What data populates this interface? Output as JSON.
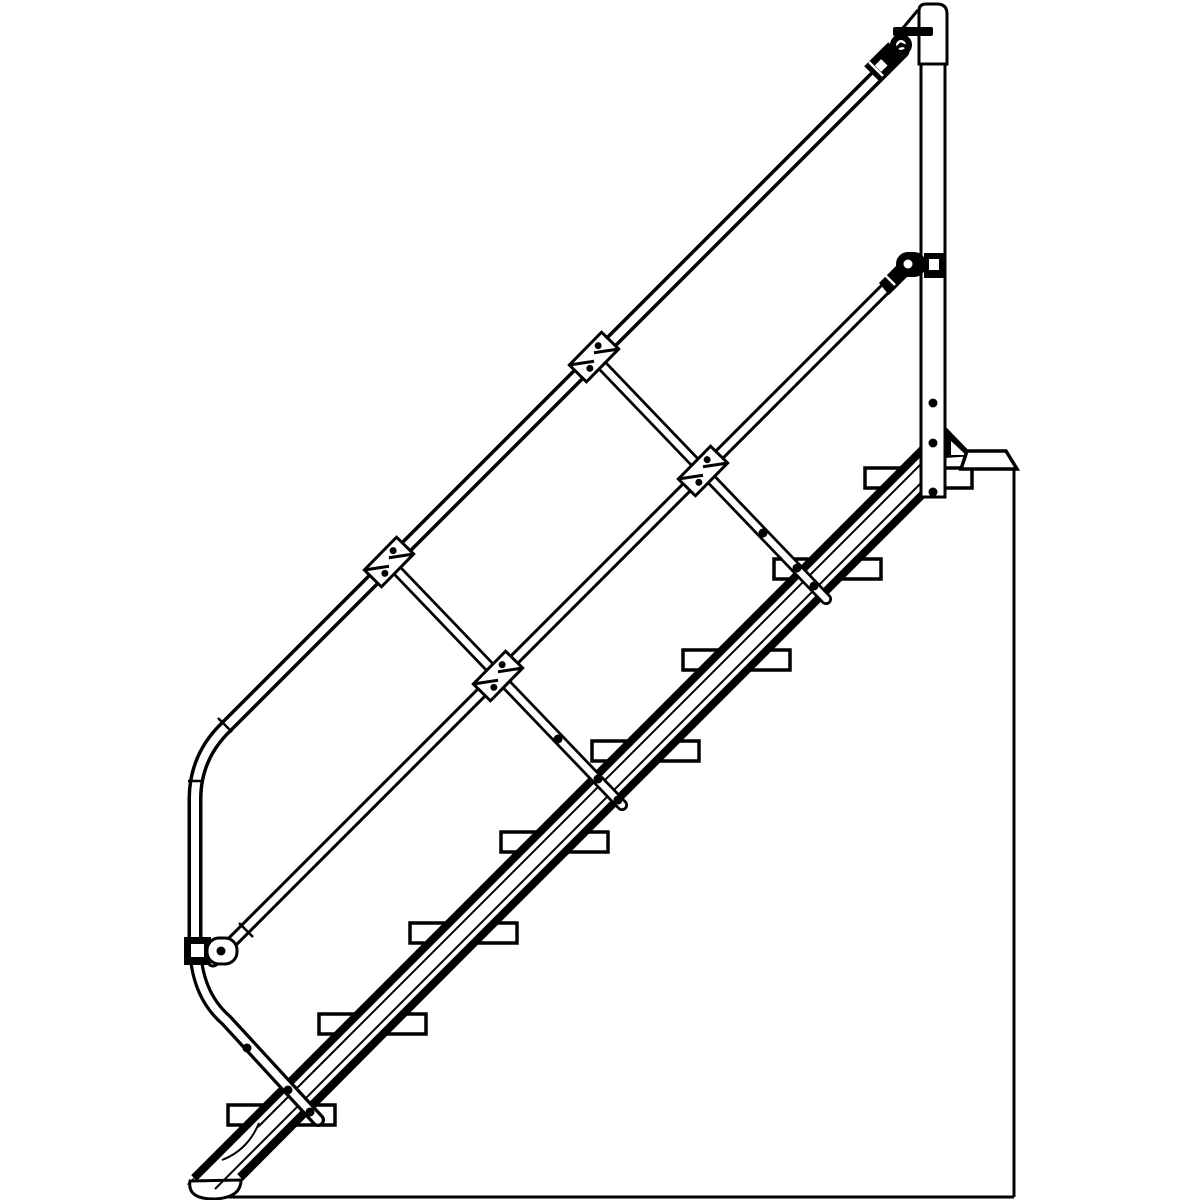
{
  "drawing": {
    "kind": "industrial-incline-stair-technical-line-art",
    "paper_color": "#ffffff",
    "ink_color": "#000000",
    "incline_degrees": 45,
    "step_count": 8,
    "baluster_count": 2
  },
  "treads": {
    "count": 8,
    "x0": 228,
    "y0": 1105,
    "dx": 91,
    "dy": -91,
    "width": 107,
    "height": 20,
    "stroke_width": 3.5
  },
  "tubes": [
    {
      "name": "baluster-1",
      "d": "M 389,562 L 622,805",
      "outer": 12,
      "inner": 6.5
    },
    {
      "name": "baluster-2",
      "d": "M 594,357 L 826,599",
      "outer": 12,
      "inner": 6.5
    },
    {
      "name": "knee-rail",
      "d": "M 892,282 L 213,961",
      "outer": 13,
      "inner": 7
    },
    {
      "name": "handrail",
      "d": "M 902,51 L 226,727 Q 195,757 195,799 L 195,945",
      "outer": 15,
      "inner": 8
    },
    {
      "name": "handrail-end-post",
      "d": "M 195,945 Q 196,994 226,1020 L 318,1120",
      "outer": 14,
      "inner": 7.5
    }
  ],
  "weld_seams": {
    "stroke_width": 2.5,
    "lines": [
      [
        218,
        718,
        232,
        732
      ],
      [
        188,
        781,
        203,
        781
      ],
      [
        239,
        923,
        253,
        937
      ]
    ]
  },
  "white_seams": {
    "stroke_width": 2.5,
    "lines": [
      [
        869,
        62,
        883,
        76
      ],
      [
        881,
        271,
        895,
        285
      ]
    ]
  },
  "rail_clamps": {
    "width": 46,
    "height": 24,
    "angle": -45.5,
    "dot_radius": 3.5,
    "centers": [
      [
        389,
        562
      ],
      [
        594,
        357
      ],
      [
        498,
        676
      ],
      [
        703,
        471
      ]
    ]
  },
  "rivets": {
    "radius": 4.5,
    "points": [
      [
        247,
        1048
      ],
      [
        288,
        1090
      ],
      [
        310,
        1112
      ],
      [
        558,
        739
      ],
      [
        598,
        779
      ],
      [
        618,
        800
      ],
      [
        763,
        533
      ],
      [
        797,
        568
      ],
      [
        814,
        586
      ],
      [
        933,
        403
      ],
      [
        933,
        443
      ],
      [
        933,
        492
      ]
    ]
  },
  "stringer": {
    "top_edge": [
      194,
      1178,
      945,
      427
    ],
    "bottom_edge": [
      240,
      1177,
      943,
      474
    ],
    "edge_stroke": 8,
    "inner_lines": [
      [
        258,
        1127,
        938,
        447
      ],
      [
        215,
        1189,
        930,
        474
      ]
    ],
    "inner_stroke": 2
  },
  "scene": {
    "ground_line": [
      200,
      1197,
      1014,
      1197
    ],
    "wall_line": [
      1014,
      470,
      1014,
      1197
    ],
    "outline_stroke": 3
  }
}
